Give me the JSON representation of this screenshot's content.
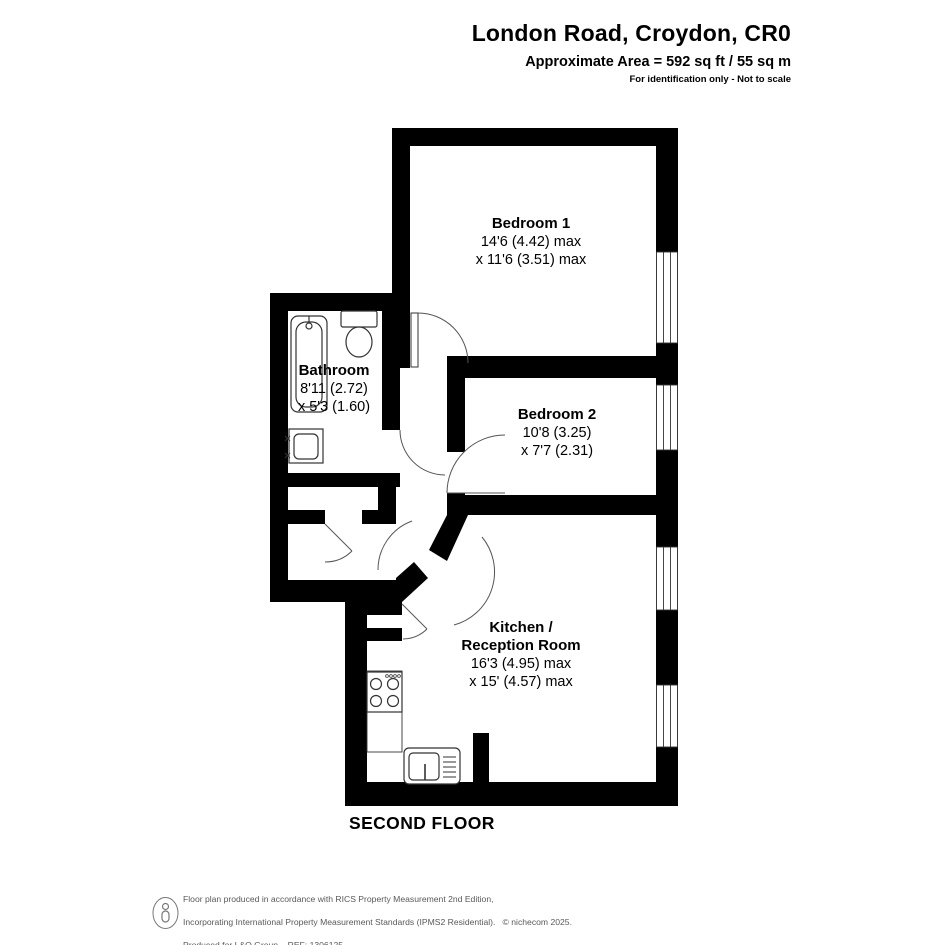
{
  "header": {
    "title": "London Road, Croydon, CR0",
    "area_line": "Approximate Area = 592 sq ft / 55 sq m",
    "disclaimer": "For identification only - Not to scale"
  },
  "plan": {
    "rooms": {
      "bedroom1": {
        "name": "Bedroom 1",
        "dim1": "14'6 (4.42) max",
        "dim2": "x 11'6 (3.51) max"
      },
      "bedroom2": {
        "name": "Bedroom 2",
        "dim1": "10'8 (3.25)",
        "dim2": "x 7'7 (2.31)"
      },
      "bathroom": {
        "name": "Bathroom",
        "dim1": "8'11 (2.72)",
        "dim2": "x 5'3 (1.60)"
      },
      "kitchen": {
        "name_line1": "Kitchen /",
        "name_line2": "Reception Room",
        "dim1": "16'3 (4.95) max",
        "dim2": "x 15' (4.57) max"
      }
    },
    "floor_label": "SECOND FLOOR"
  },
  "footer": {
    "line1": "Floor plan produced in accordance with RICS Property Measurement 2nd Edition,",
    "line2": "Incorporating International Property Measurement Standards (IPMS2 Residential).   © nichecom 2025.",
    "line3": "Produced for L&Q Group.   REF: 1306125"
  },
  "colors": {
    "wall": "#000000",
    "text": "#000000",
    "footer_text": "#595959"
  }
}
